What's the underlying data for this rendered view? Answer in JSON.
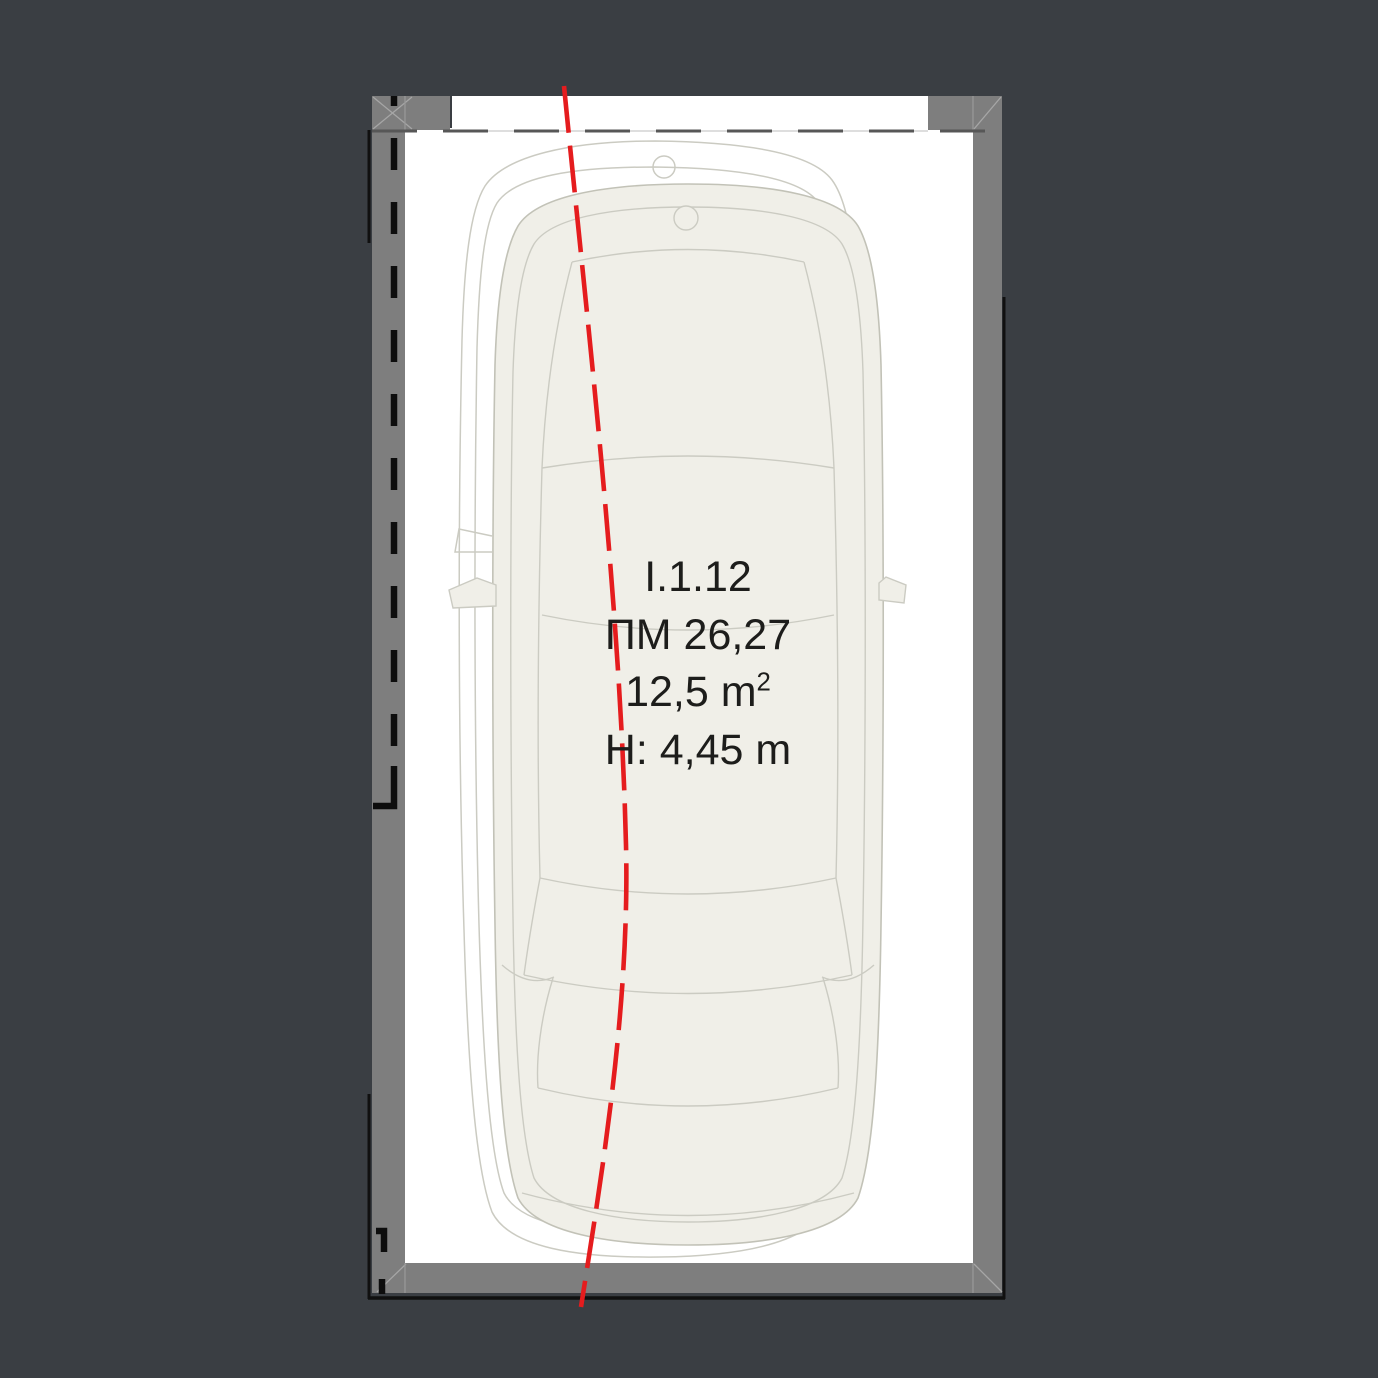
{
  "plan": {
    "space_id": "I.1.12",
    "space_label": "ПМ 26,27",
    "area_value": "12,5 m",
    "area_exponent": "2",
    "height_label": "H: 4,45 m"
  },
  "colors": {
    "background": "#3a3e43",
    "floor": "#ffffff",
    "wall": "#7e7e7e",
    "wall-diagonal": "#a6a6a6",
    "wall-separator": "#989898",
    "outline-black": "#101010",
    "entry-dash": "#575757",
    "entry-underline": "#c9c9c9",
    "boundary-dash": "#0d0d0d",
    "centerline-red": "#e51c1e",
    "car-fill": "#f0efe8",
    "car-stroke": "#c2c2b7",
    "car-line": "#cbcbc2",
    "ghost-stroke": "#cbcbc2",
    "text": "#1d1d1b"
  }
}
